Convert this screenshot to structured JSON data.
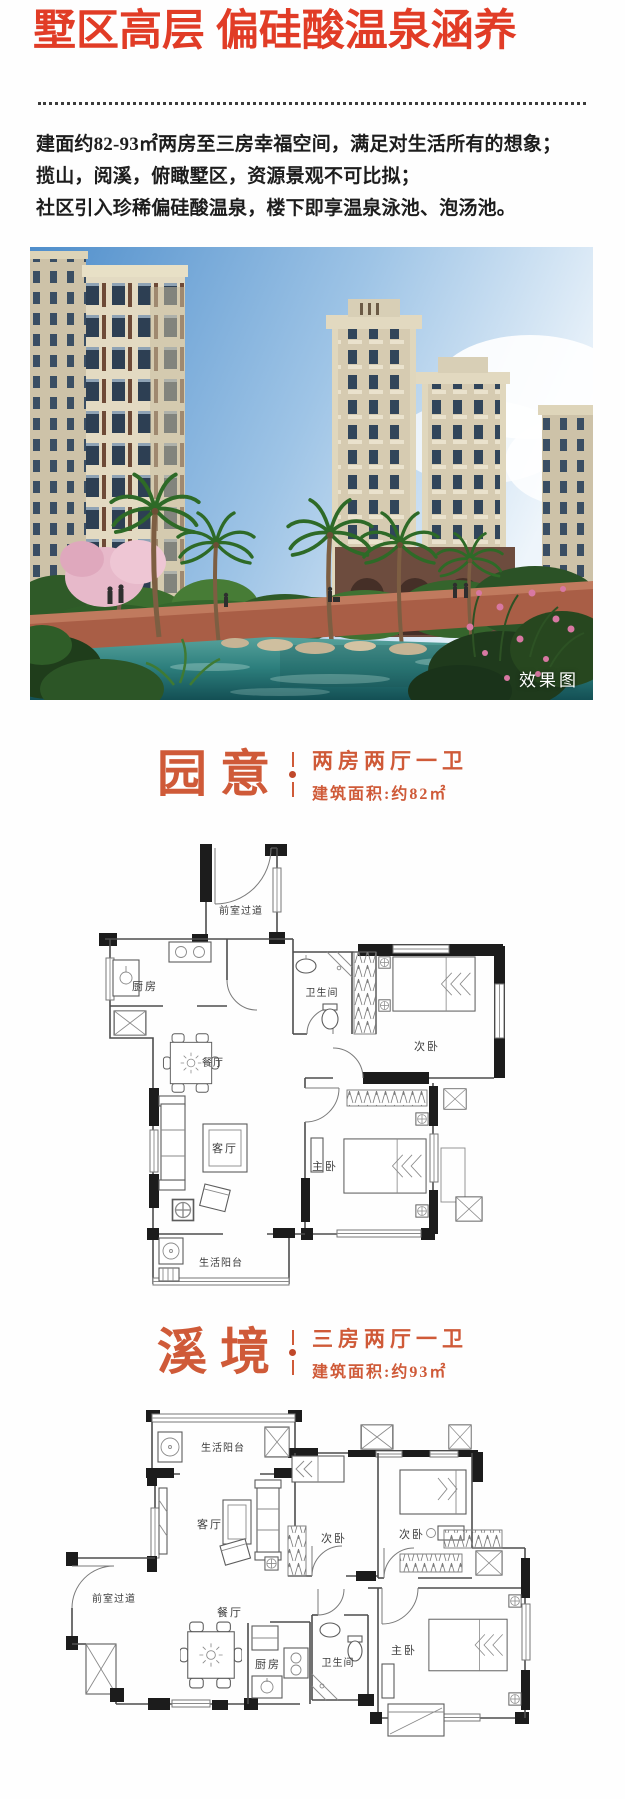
{
  "colors": {
    "title_red": "#e13c26",
    "section_orange": "#cf5a38",
    "body_text": "#1d1d1d",
    "plan_wall": "#1c1c1c"
  },
  "header": {
    "title": "墅区高层 偏硅酸温泉涵养"
  },
  "intro": {
    "line1": "建面约82-93㎡两房至三房幸福空间，满足对生活所有的想象；",
    "line2": "揽山，阅溪，俯瞰墅区，资源景观不可比拟；",
    "line3": "社区引入珍稀偏硅酸温泉，楼下即享温泉泳池、泡汤池。"
  },
  "hero": {
    "watermark": "效果图"
  },
  "plan1": {
    "name": "园意",
    "layout": "两房两厅一卫",
    "area": "建筑面积:约82㎡",
    "rooms": {
      "corridor": "前室过道",
      "kitchen": "厨房",
      "bath": "卫生间",
      "bedroom2": "次卧",
      "dining": "餐厅",
      "living": "客厅",
      "master": "主卧",
      "balcony": "生活阳台"
    }
  },
  "plan2": {
    "name": "溪境",
    "layout": "三房两厅一卫",
    "area": "建筑面积:约93㎡",
    "rooms": {
      "balcony": "生活阳台",
      "living": "客厅",
      "bedroom2a": "次卧",
      "bedroom2b": "次卧",
      "corridor": "前室过道",
      "dining": "餐厅",
      "kitchen": "厨房",
      "bath": "卫生间",
      "master": "主卧"
    }
  }
}
